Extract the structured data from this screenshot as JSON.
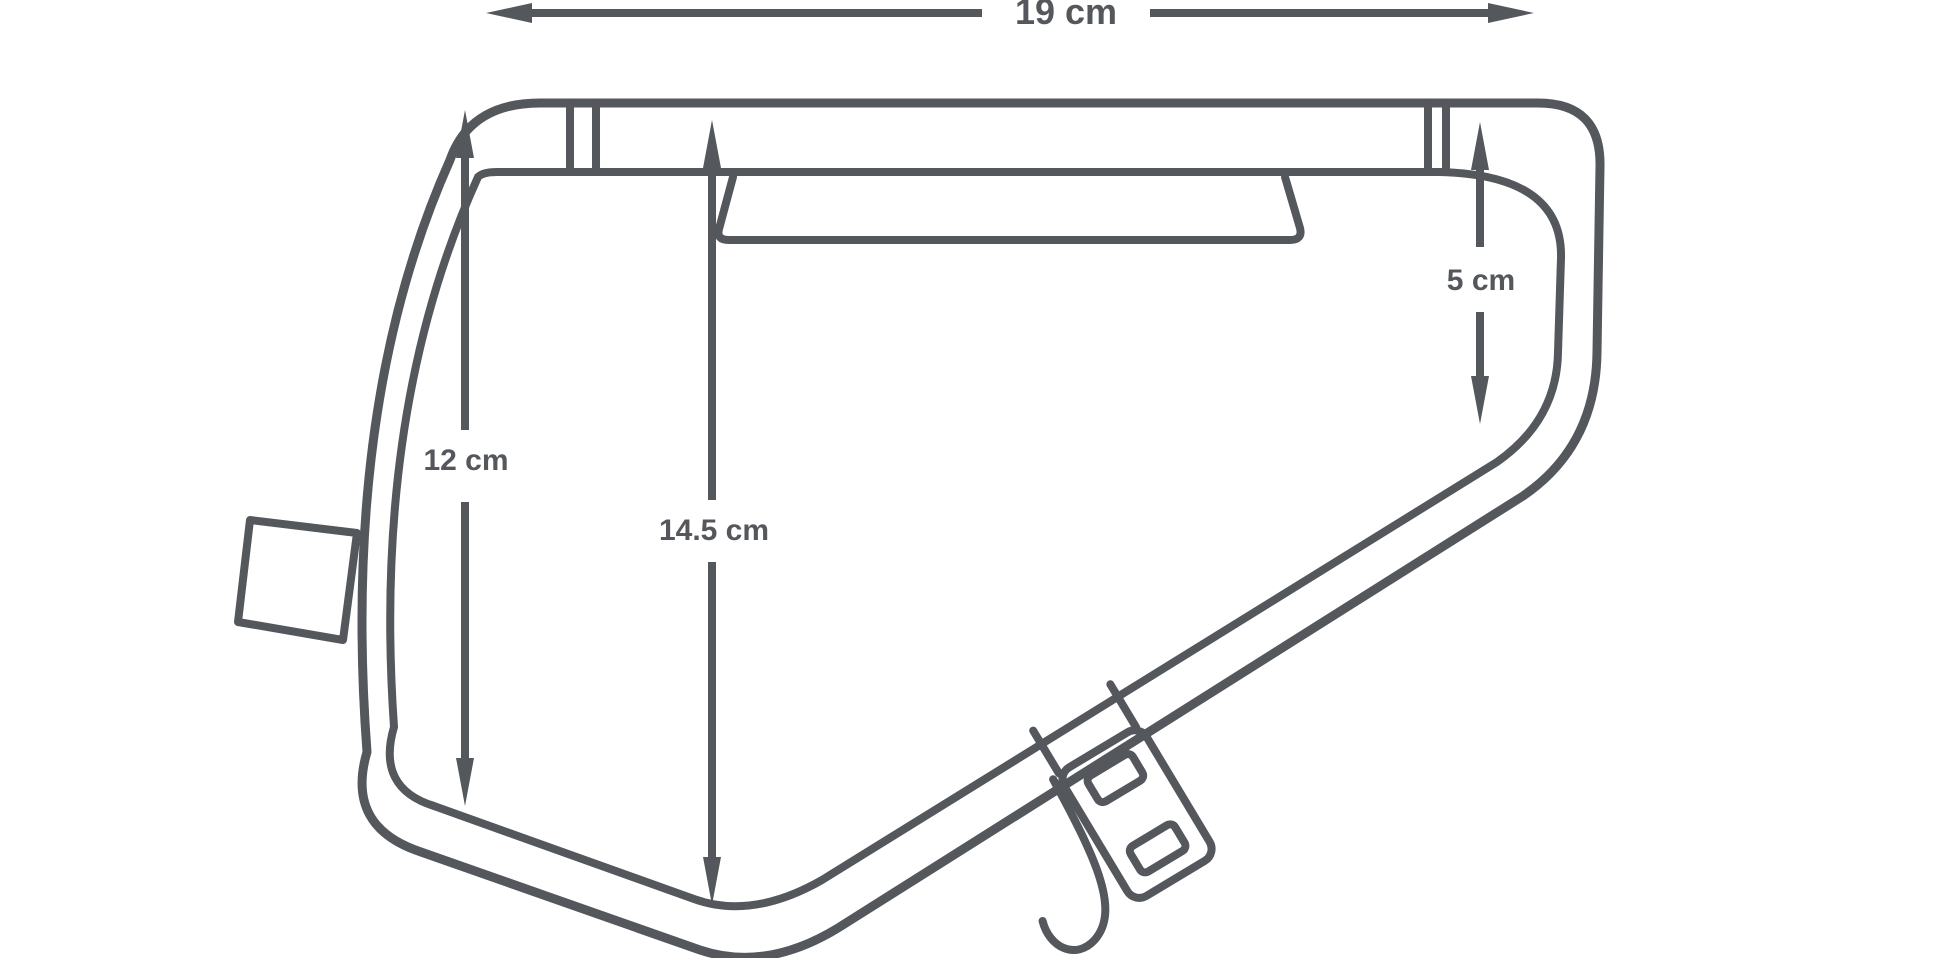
{
  "theme": {
    "bg": "#ffffff",
    "line": "#54575b",
    "label": "#54575b"
  },
  "diagram": {
    "kind": "frame-bag-dimension-diagram",
    "labels": {
      "top_width": "19 cm",
      "left_height": "12 cm",
      "center_height": "14.5 cm",
      "right_height": "5 cm"
    }
  }
}
